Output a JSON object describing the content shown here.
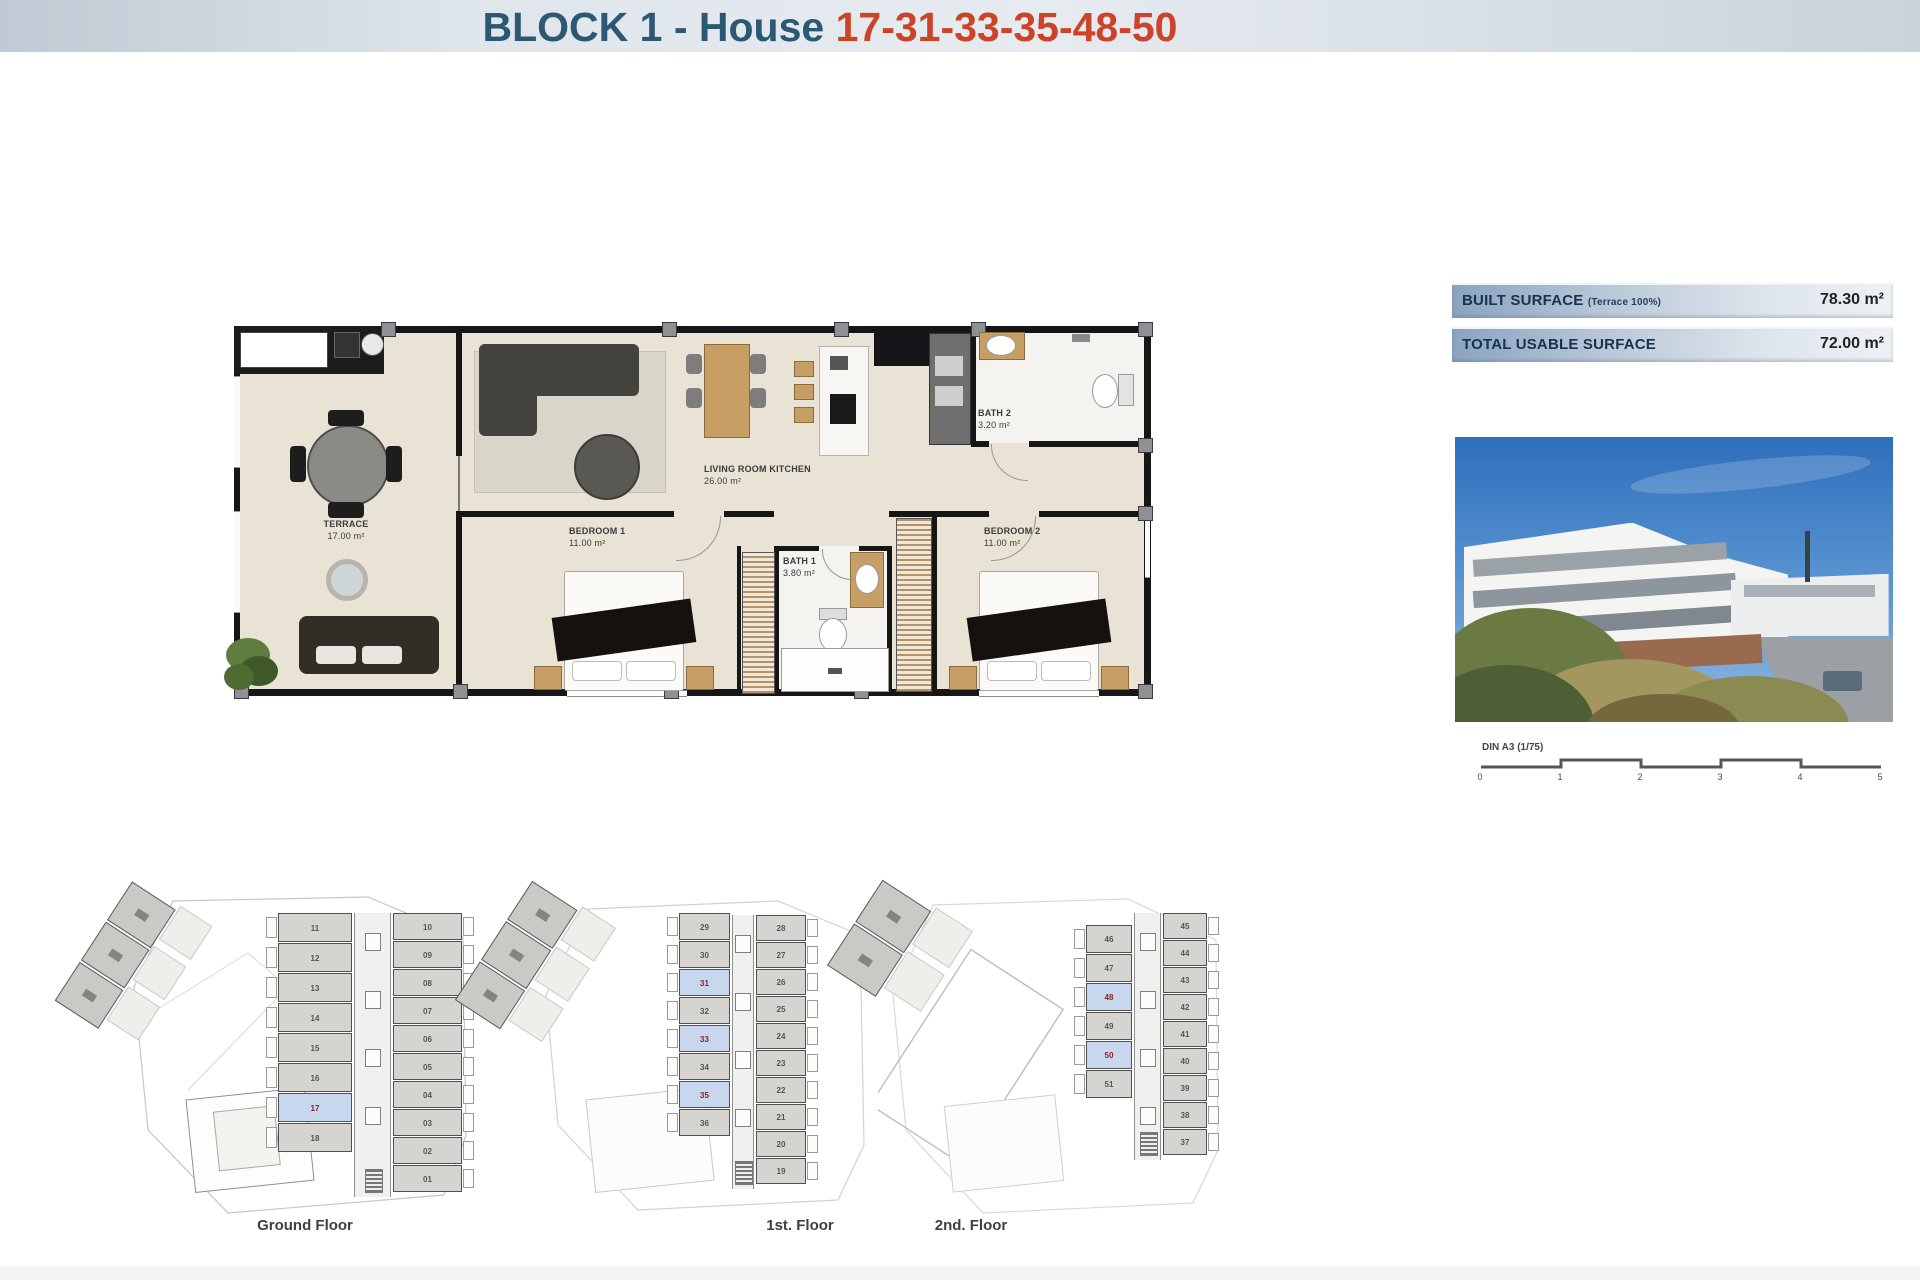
{
  "header": {
    "title_prefix": "BLOCK 1 - House ",
    "title_numbers": "17-31-33-35-48-50"
  },
  "surface_info": {
    "rows": [
      {
        "label": "BUILT SURFACE",
        "note": "(Terrace 100%)",
        "value": "78.30 m²"
      },
      {
        "label": "TOTAL USABLE SURFACE",
        "note": "",
        "value": "72.00 m²"
      }
    ]
  },
  "floor_plan": {
    "rooms": {
      "terrace": {
        "name": "TERRACE",
        "area": "17.00 m²"
      },
      "living": {
        "name": "LIVING ROOM KITCHEN",
        "area": "26.00 m²"
      },
      "bedroom1": {
        "name": "BEDROOM 1",
        "area": "11.00 m²"
      },
      "bath1": {
        "name": "BATH 1",
        "area": "3.80 m²"
      },
      "bedroom2": {
        "name": "BEDROOM 2",
        "area": "11.00 m²"
      },
      "bath2": {
        "name": "BATH 2",
        "area": "3.20 m²"
      }
    }
  },
  "scale_bar": {
    "label": "DIN A3 (1/75)",
    "ticks": [
      "0",
      "1",
      "2",
      "3",
      "4",
      "5"
    ]
  },
  "floors": [
    {
      "caption": "Ground Floor",
      "left_units": [
        "11",
        "12",
        "13",
        "14",
        "15",
        "16",
        "17",
        "18"
      ],
      "right_units": [
        "10",
        "09",
        "08",
        "07",
        "06",
        "05",
        "04",
        "03",
        "02",
        "01"
      ],
      "highlighted": [
        "17"
      ]
    },
    {
      "caption": "1st. Floor",
      "left_units": [
        "29",
        "30",
        "31",
        "32",
        "33",
        "34",
        "35",
        "36"
      ],
      "right_units": [
        "28",
        "27",
        "26",
        "25",
        "24",
        "23",
        "22",
        "21",
        "20",
        "19"
      ],
      "highlighted": [
        "31",
        "33",
        "35"
      ]
    },
    {
      "caption": "2nd. Floor",
      "left_units": [
        "46",
        "47",
        "48",
        "49",
        "50",
        "51"
      ],
      "right_units": [
        "45",
        "44",
        "43",
        "42",
        "41",
        "40",
        "39",
        "38",
        "37"
      ],
      "highlighted": [
        "48",
        "50"
      ]
    }
  ],
  "colors": {
    "title_blue": "#2c5872",
    "title_red": "#cc4327",
    "highlight_fill": "#c9d7ee",
    "highlight_number": "#8e1f1f"
  }
}
